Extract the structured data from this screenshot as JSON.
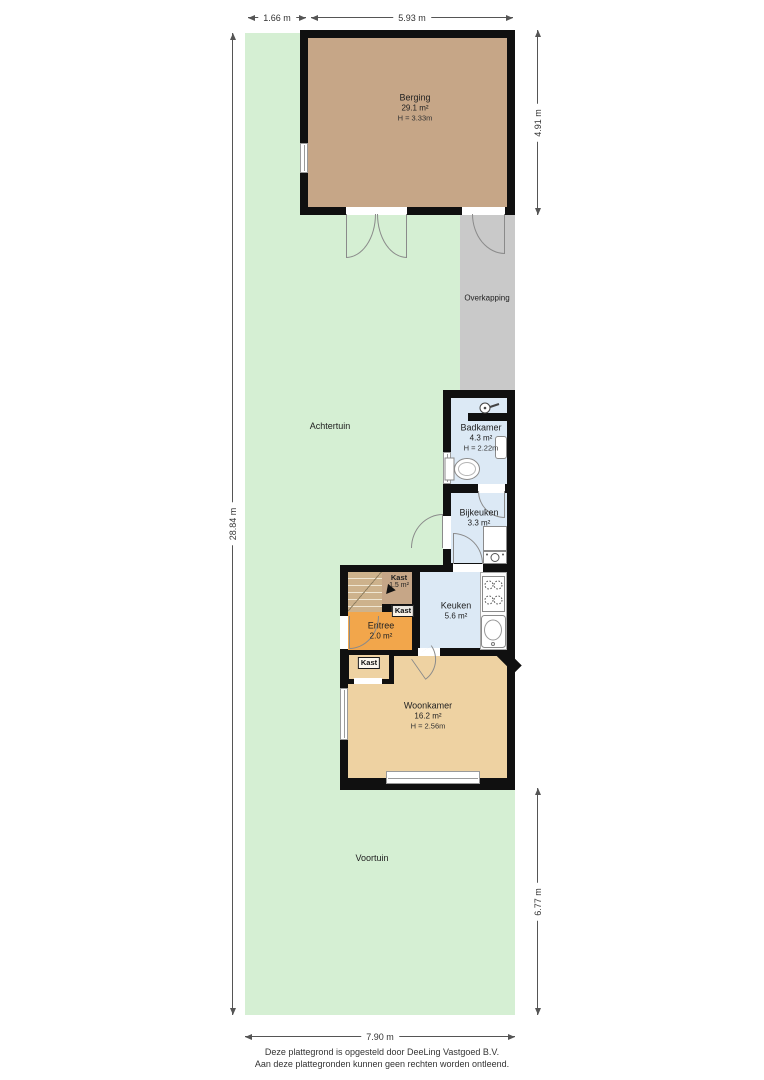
{
  "colors": {
    "garden": "#d5efd3",
    "overkapping": "#c9c9c9",
    "berging": "#c6a687",
    "wet": "#dce9f5",
    "entree": "#f2a64b",
    "living": "#eed2a2",
    "wall": "#101010"
  },
  "dimensions": {
    "top_left": "1.66 m",
    "top_right": "5.93 m",
    "left": "28.84 m",
    "right_top": "4.91 m",
    "right_bottom": "6.77 m",
    "bottom": "7.90 m"
  },
  "garden": {
    "achtertuin": "Achtertuin",
    "voortuin": "Voortuin",
    "overkapping": "Overkapping"
  },
  "rooms": {
    "berging": {
      "name": "Berging",
      "area": "29.1 m²",
      "height": "H = 3.33m"
    },
    "badkamer": {
      "name": "Badkamer",
      "area": "4.3 m²",
      "height": "H = 2.22m"
    },
    "bijkeuken": {
      "name": "Bijkeuken",
      "area": "3.3 m²"
    },
    "kast_trap": {
      "name": "Kast",
      "area": "1.5 m²"
    },
    "kast_midden": {
      "name": "Kast"
    },
    "kast_onder": {
      "name": "Kast"
    },
    "entree": {
      "name": "Entree",
      "area": "2.0 m²"
    },
    "keuken": {
      "name": "Keuken",
      "area": "5.6 m²"
    },
    "woonkamer": {
      "name": "Woonkamer",
      "area": "16.2 m²",
      "height": "H = 2.56m"
    }
  },
  "icons": {
    "shower": "shower-icon",
    "toilet": "toilet-icon",
    "washer": "washing-machine-icon",
    "stove": "stove-icon",
    "sink": "sink-icon"
  },
  "footer": {
    "line1": "Deze plattegrond is opgesteld door DeeLing Vastgoed B.V.",
    "line2": "Aan deze plattegronden kunnen geen rechten worden ontleend."
  }
}
